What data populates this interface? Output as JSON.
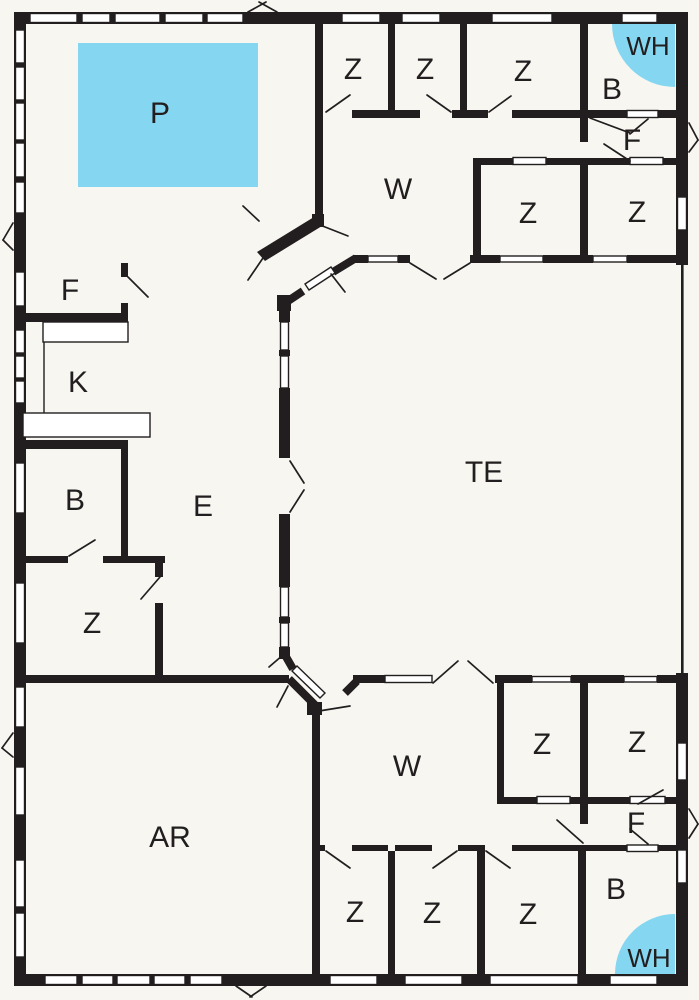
{
  "plan_title": "floor-plan",
  "colors": {
    "background": "#f7f6f1",
    "wall": "#221e1f",
    "pool": "#85d7f1",
    "window": "#ffffff",
    "label": "#221e1f"
  },
  "rooms": {
    "pool": {
      "label": "P"
    },
    "z_top_1": {
      "label": "Z"
    },
    "z_top_2": {
      "label": "Z"
    },
    "z_top_3": {
      "label": "Z"
    },
    "wh_top": {
      "label": "WH"
    },
    "b_top": {
      "label": "B"
    },
    "f_top": {
      "label": "F"
    },
    "w_top": {
      "label": "W"
    },
    "z_midtop_1": {
      "label": "Z"
    },
    "z_midtop_2": {
      "label": "Z"
    },
    "f_left": {
      "label": "F"
    },
    "kitchen": {
      "label": "K"
    },
    "terrace": {
      "label": "TE"
    },
    "b_left": {
      "label": "B"
    },
    "entry": {
      "label": "E"
    },
    "z_left": {
      "label": "Z"
    },
    "activity": {
      "label": "AR"
    },
    "w_bottom": {
      "label": "W"
    },
    "z_midbot_1": {
      "label": "Z"
    },
    "z_midbot_2": {
      "label": "Z"
    },
    "f_bottom": {
      "label": "F"
    },
    "b_bottom": {
      "label": "B"
    },
    "wh_bottom": {
      "label": "WH"
    },
    "z_bot_1": {
      "label": "Z"
    },
    "z_bot_2": {
      "label": "Z"
    },
    "z_bot_3": {
      "label": "Z"
    }
  }
}
